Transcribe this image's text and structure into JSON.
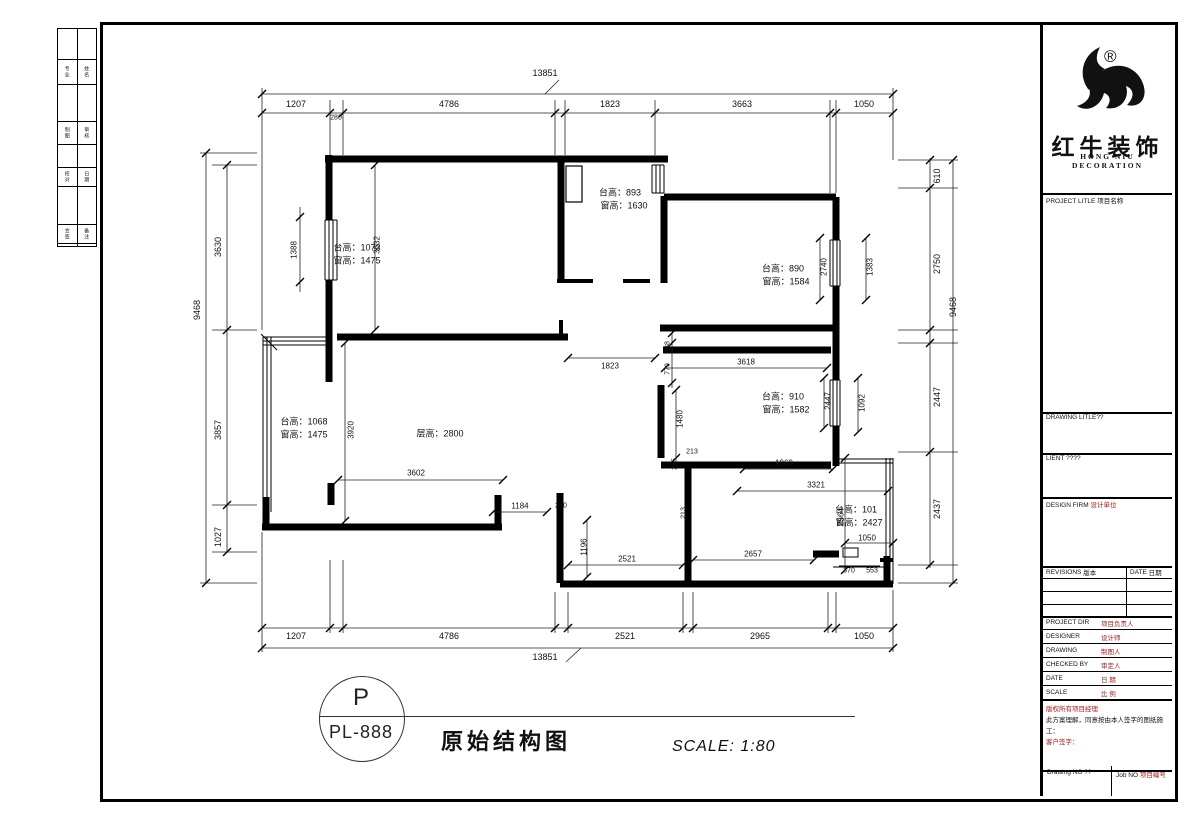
{
  "colors": {
    "accent_red": "#a61c1c",
    "line_black": "#000000"
  },
  "sheet_strip": {
    "rows": [
      {
        "a": "专业",
        "b": "姓名"
      },
      {
        "a": "制图",
        "b": "审核"
      },
      {
        "a": "校对",
        "b": "日期"
      },
      {
        "a": "会签",
        "b": "备注"
      }
    ]
  },
  "titleblock": {
    "reg": "®",
    "brand_cn": "红牛装饰",
    "brand_en": "HONG NIU DECORATION",
    "project_title_en": "PROJECT LITLE",
    "project_title_cn": "项目名称",
    "drawing_title": "DRAWING LITLE??",
    "client": "LIENT ????",
    "design_firm_en": "DESIGN FIRM",
    "design_firm_cn": "设计单位",
    "revisions_en": "REVISIONS",
    "revisions_cn": "版本",
    "date_en": "DATE",
    "date_cn": "日期",
    "staff": [
      {
        "en": "PROJECT DIR",
        "cn": "项目负责人"
      },
      {
        "en": "DESIGNER",
        "cn": "设计师"
      },
      {
        "en": "DRAWING",
        "cn": "制图人"
      },
      {
        "en": "CHECKED BY",
        "cn": "审定人"
      },
      {
        "en": "DATE",
        "cn": "日 期"
      },
      {
        "en": "SCALE",
        "cn": "比 例"
      }
    ],
    "copyright": "版权所有项目经理",
    "agreement": "此方案理解，同意按由本人签字的图纸施工：",
    "client_sign": "客户签字：",
    "drawing_no": "Drawing NO ??",
    "job_no_en": "Job NO",
    "job_no_cn": "项目编号"
  },
  "footer": {
    "circle_top": "P",
    "circle_no": "PL-888",
    "title": "原始结构图",
    "scale": "SCALE: 1:80"
  },
  "plan": {
    "dim_labels": [
      {
        "t": "13851",
        "x": 545,
        "y": 73
      },
      {
        "t": "1207",
        "x": 296,
        "y": 104
      },
      {
        "t": "280",
        "x": 336,
        "y": 118,
        "s": 7
      },
      {
        "t": "4786",
        "x": 449,
        "y": 104
      },
      {
        "t": "1823",
        "x": 610,
        "y": 104
      },
      {
        "t": "3663",
        "x": 742,
        "y": 104
      },
      {
        "t": "1050",
        "x": 864,
        "y": 104
      },
      {
        "t": "1207",
        "x": 296,
        "y": 636
      },
      {
        "t": "4786",
        "x": 449,
        "y": 636
      },
      {
        "t": "2521",
        "x": 625,
        "y": 636
      },
      {
        "t": "2965",
        "x": 760,
        "y": 636
      },
      {
        "t": "1050",
        "x": 864,
        "y": 636
      },
      {
        "t": "13851",
        "x": 545,
        "y": 657
      },
      {
        "t": "9468",
        "x": 197,
        "y": 310,
        "r": -90
      },
      {
        "t": "3630",
        "x": 218,
        "y": 247,
        "r": -90
      },
      {
        "t": "3857",
        "x": 218,
        "y": 430,
        "r": -90
      },
      {
        "t": "1027",
        "x": 218,
        "y": 537,
        "r": -90
      },
      {
        "t": "1388",
        "x": 294,
        "y": 250,
        "r": -90,
        "s": 8
      },
      {
        "t": "610",
        "x": 937,
        "y": 176,
        "r": -90
      },
      {
        "t": "2750",
        "x": 937,
        "y": 264,
        "r": -90
      },
      {
        "t": "9468",
        "x": 953,
        "y": 307,
        "r": -90
      },
      {
        "t": "2447",
        "x": 937,
        "y": 397,
        "r": -90
      },
      {
        "t": "2437",
        "x": 937,
        "y": 509,
        "r": -90
      },
      {
        "t": "3632",
        "x": 377,
        "y": 245,
        "r": -90,
        "s": 8
      },
      {
        "t": "1823",
        "x": 610,
        "y": 366,
        "s": 8
      },
      {
        "t": "188",
        "x": 668,
        "y": 347,
        "r": -90,
        "s": 7
      },
      {
        "t": "779",
        "x": 668,
        "y": 369,
        "r": -90,
        "s": 7
      },
      {
        "t": "3618",
        "x": 746,
        "y": 362,
        "s": 8
      },
      {
        "t": "2740",
        "x": 824,
        "y": 267,
        "r": -90,
        "s": 8
      },
      {
        "t": "1383",
        "x": 870,
        "y": 267,
        "r": -90,
        "s": 8
      },
      {
        "t": "1480",
        "x": 680,
        "y": 419,
        "r": -90,
        "s": 8
      },
      {
        "t": "2447",
        "x": 828,
        "y": 401,
        "r": -90,
        "s": 8
      },
      {
        "t": "1092",
        "x": 862,
        "y": 403,
        "r": -90,
        "s": 8
      },
      {
        "t": "213",
        "x": 692,
        "y": 452,
        "s": 7
      },
      {
        "t": "235",
        "x": 675,
        "y": 464,
        "r": -90,
        "s": 7
      },
      {
        "t": "3920",
        "x": 351,
        "y": 430,
        "r": -90,
        "s": 8
      },
      {
        "t": "3602",
        "x": 416,
        "y": 473,
        "s": 8
      },
      {
        "t": "1184",
        "x": 520,
        "y": 506,
        "s": 8
      },
      {
        "t": "280",
        "x": 561,
        "y": 506,
        "s": 7
      },
      {
        "t": "1196",
        "x": 584,
        "y": 547,
        "r": -90,
        "s": 8
      },
      {
        "t": "2521",
        "x": 627,
        "y": 559,
        "s": 8
      },
      {
        "t": "2657",
        "x": 753,
        "y": 554,
        "s": 8
      },
      {
        "t": "1969",
        "x": 784,
        "y": 463,
        "s": 8
      },
      {
        "t": "3321",
        "x": 816,
        "y": 485,
        "s": 8
      },
      {
        "t": "2564",
        "x": 841,
        "y": 517,
        "r": -90,
        "s": 8
      },
      {
        "t": "1050",
        "x": 867,
        "y": 538,
        "s": 8
      },
      {
        "t": "370",
        "x": 849,
        "y": 571,
        "s": 7
      },
      {
        "t": "553",
        "x": 872,
        "y": 571,
        "s": 7
      },
      {
        "t": "213",
        "x": 684,
        "y": 513,
        "r": -90,
        "s": 7
      }
    ],
    "room_labels": [
      {
        "t": "台高：1073",
        "x": 357,
        "y": 247
      },
      {
        "t": "窗高：1475",
        "x": 357,
        "y": 260
      },
      {
        "t": "台高：893",
        "x": 620,
        "y": 192
      },
      {
        "t": "窗高：1630",
        "x": 624,
        "y": 205
      },
      {
        "t": "台高：890",
        "x": 783,
        "y": 268
      },
      {
        "t": "窗高：1584",
        "x": 786,
        "y": 281
      },
      {
        "t": "台高：910",
        "x": 783,
        "y": 396
      },
      {
        "t": "窗高：1582",
        "x": 786,
        "y": 409
      },
      {
        "t": "台高：101",
        "x": 856,
        "y": 509
      },
      {
        "t": "窗高：2427",
        "x": 859,
        "y": 522
      },
      {
        "t": "台高：1068",
        "x": 304,
        "y": 421
      },
      {
        "t": "窗高：1475",
        "x": 304,
        "y": 434
      },
      {
        "t": "层高：2800",
        "x": 440,
        "y": 433
      }
    ]
  }
}
